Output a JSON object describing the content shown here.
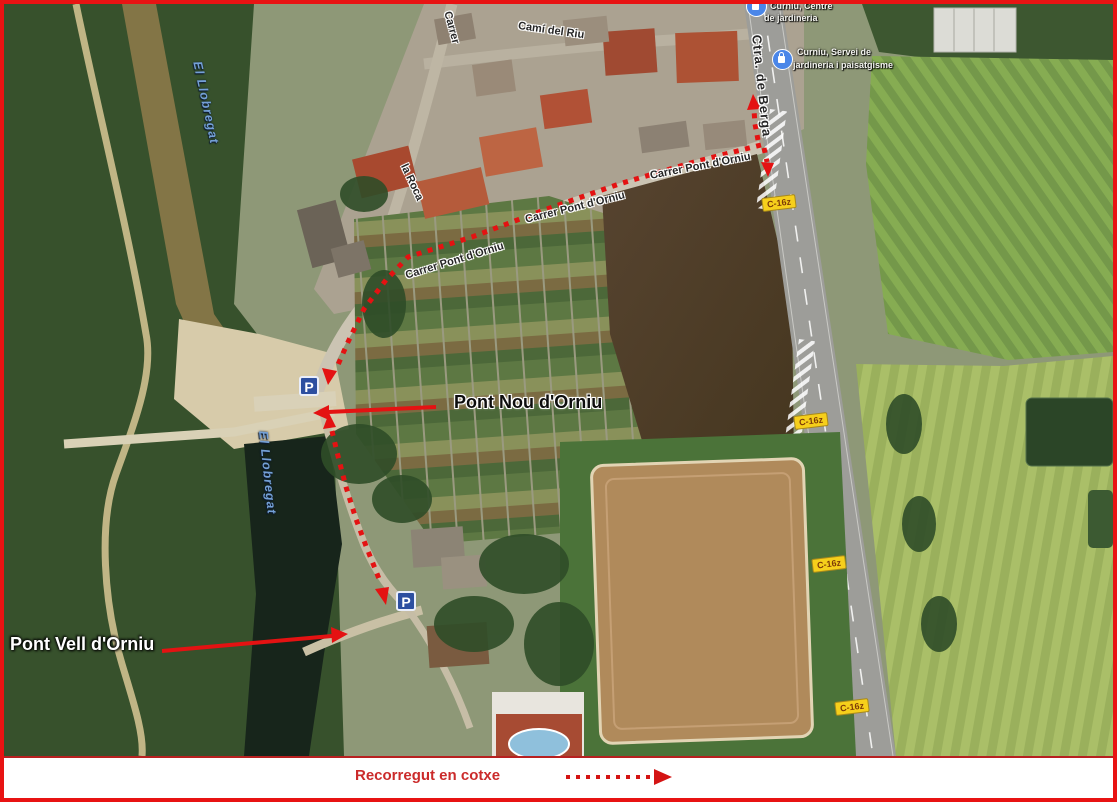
{
  "legend": {
    "text": "Recorregut en cotxe"
  },
  "map": {
    "street_labels": [
      {
        "text": "Camí del Riu"
      },
      {
        "text": "Carrer"
      },
      {
        "text": "la Roca"
      },
      {
        "text": "Carrer Pont d'Orniu"
      },
      {
        "text": "Carrer Pont d'Orniu"
      },
      {
        "text": "Carrer Pont d'Orniu"
      },
      {
        "text": "Ctra. de Berga"
      }
    ],
    "water_labels": [
      {
        "text": "El Llobregat"
      },
      {
        "text": "El Llobregat"
      }
    ],
    "pois": [
      {
        "line1": "Curniu, Centre",
        "line2": "de jardineria"
      },
      {
        "line1": "Curniu, Servei de",
        "line2": "jardineria i paisatgisme"
      }
    ],
    "road_shields": [
      {
        "text": "C-16z"
      },
      {
        "text": "C-16z"
      },
      {
        "text": "C-16z"
      },
      {
        "text": "C-16z"
      }
    ],
    "parking": [
      {
        "label": "P"
      },
      {
        "label": "P"
      }
    ],
    "annotations": [
      {
        "text": "Pont Nou d'Orniu"
      },
      {
        "text": "Pont Vell d'Orniu"
      }
    ],
    "route_color": "#e41212",
    "frame_color": "#e81313"
  }
}
